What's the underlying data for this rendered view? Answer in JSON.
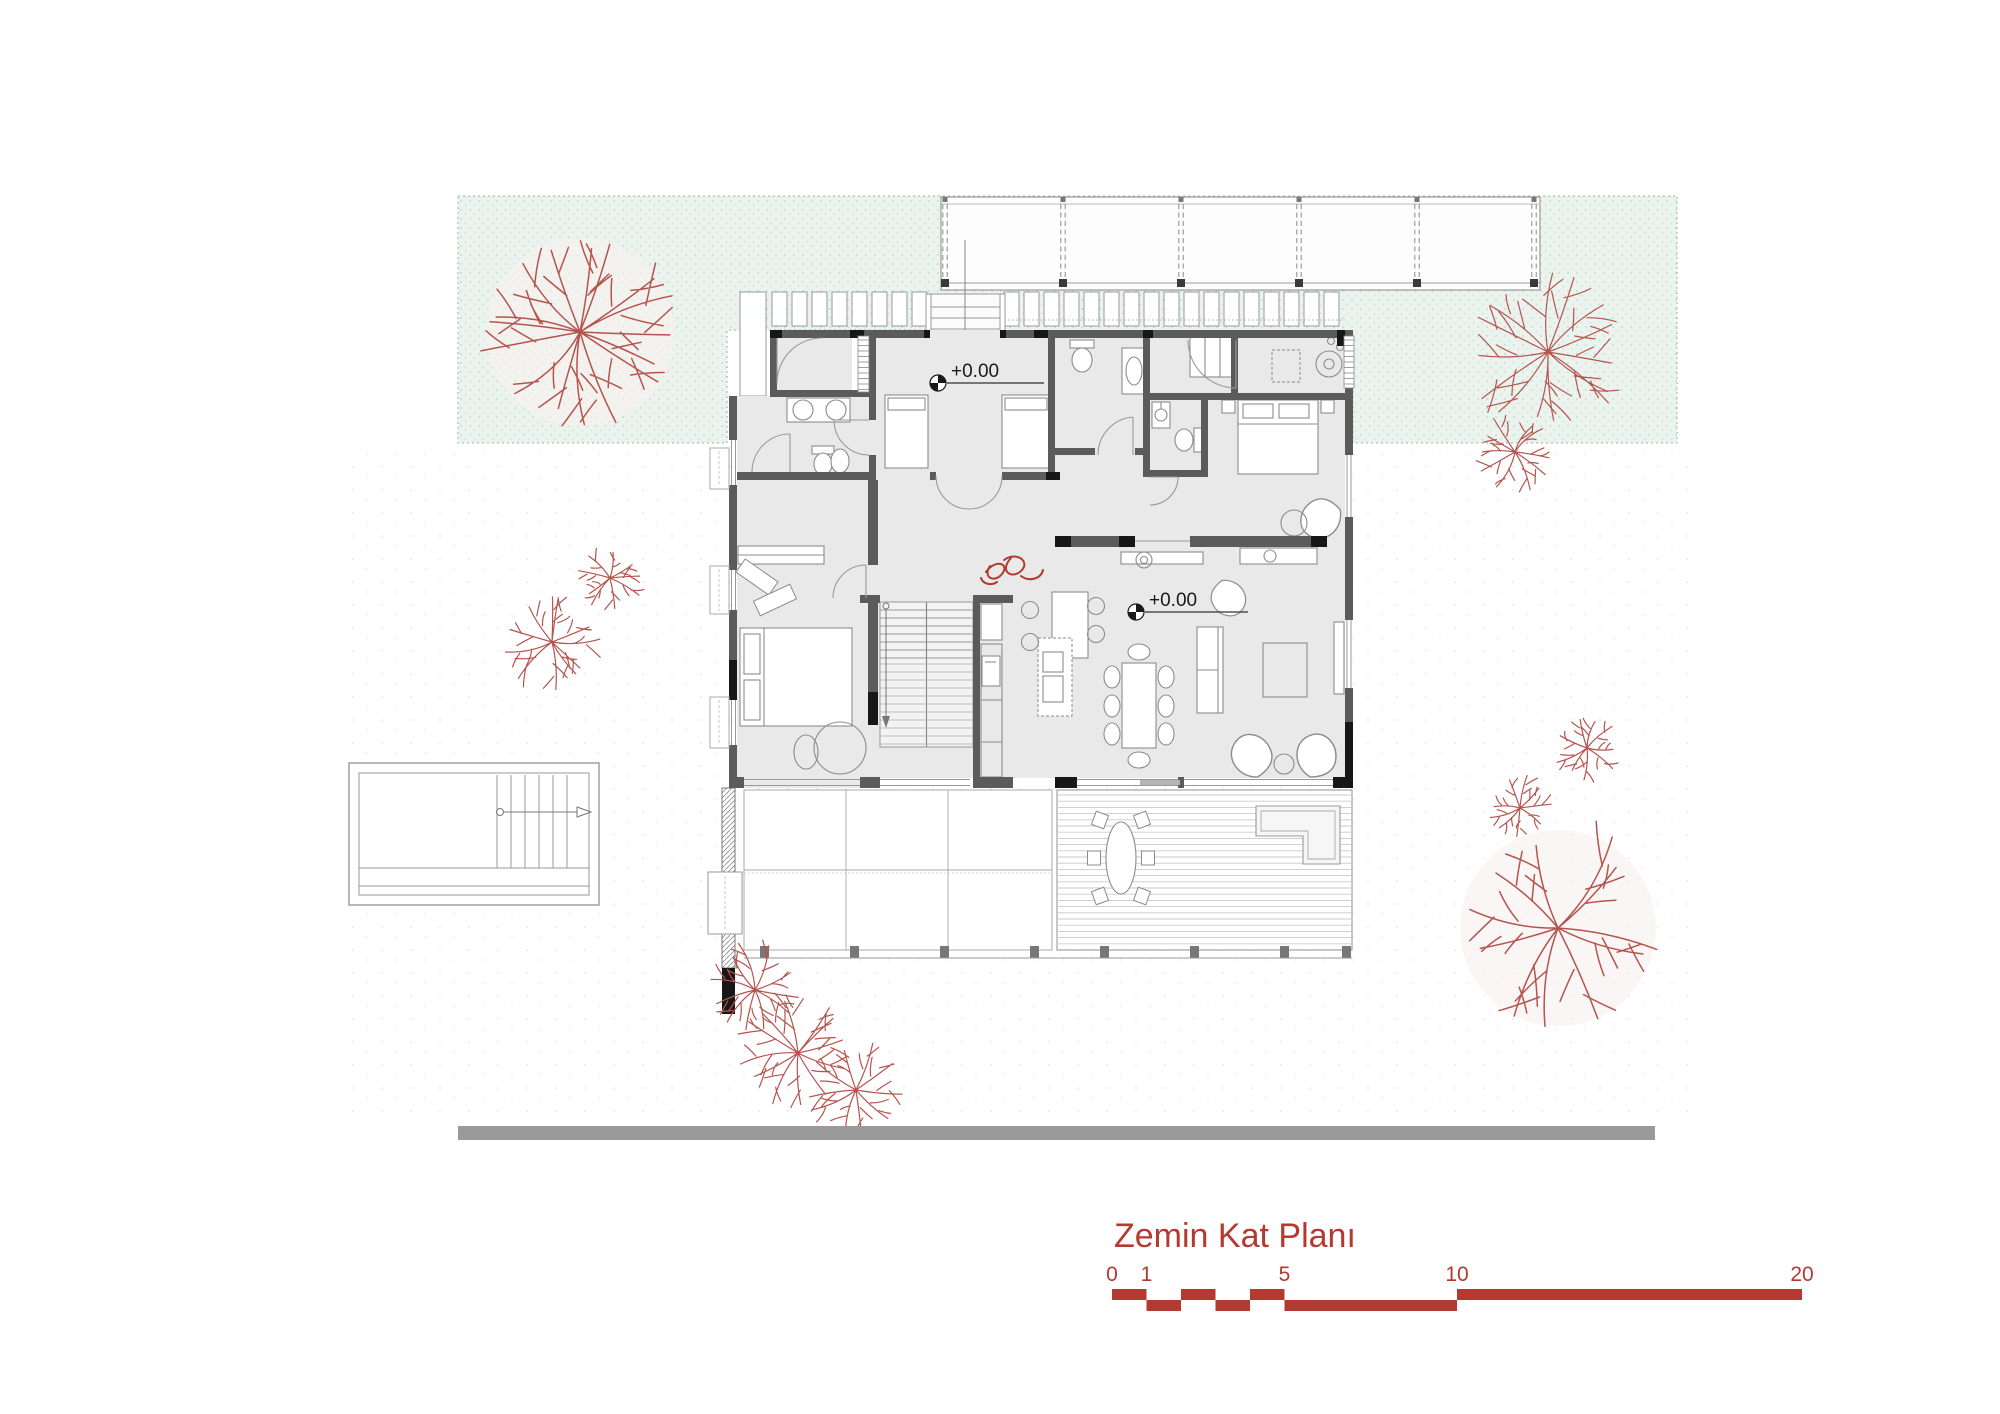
{
  "page": {
    "width": 2000,
    "height": 1414,
    "background": "#ffffff"
  },
  "title": {
    "text": "Zemin Kat Planı",
    "color": "#b23a31",
    "font_size": 34,
    "x": 1114,
    "y": 1247
  },
  "elevation_markers": [
    {
      "label": "+0.00",
      "cx": 938,
      "cy": 383,
      "text_x": 951,
      "text_y": 377,
      "underline_to": 1044
    },
    {
      "label": "+0.00",
      "cx": 1136,
      "cy": 612,
      "text_x": 1149,
      "text_y": 606,
      "underline_to": 1248
    }
  ],
  "scale_bar": {
    "x0": 1112,
    "y_top": 1289,
    "row_h": 11,
    "px_per_unit": 34.5,
    "color": "#b23a31",
    "label_baseline": 1281,
    "label_font_size": 21,
    "ticks": [
      {
        "label": "0",
        "value": 0
      },
      {
        "label": "1",
        "value": 1
      },
      {
        "label": "5",
        "value": 5
      },
      {
        "label": "10",
        "value": 10
      },
      {
        "label": "20",
        "value": 20
      }
    ],
    "segments": [
      {
        "from": 0,
        "to": 1,
        "row": "top"
      },
      {
        "from": 1,
        "to": 2,
        "row": "bottom"
      },
      {
        "from": 2,
        "to": 3,
        "row": "top"
      },
      {
        "from": 3,
        "to": 4,
        "row": "bottom"
      },
      {
        "from": 4,
        "to": 5,
        "row": "top"
      },
      {
        "from": 5,
        "to": 10,
        "row": "bottom"
      },
      {
        "from": 10,
        "to": 20,
        "row": "top"
      }
    ]
  },
  "road": {
    "x": 458,
    "y": 1126,
    "w": 1197,
    "h": 14,
    "color": "#9a9a9a"
  },
  "colors": {
    "lawn_fill": "#eaf3ee",
    "lawn_dots": "#c9ddd0",
    "lawn_border": "#9fb3a6",
    "wall": "#5b5b5b",
    "wall_accent": "#171717",
    "room_fill": "#e8e9e8",
    "furniture_stroke": "#8c8c8c",
    "thin_line": "#9a9a9a",
    "tree_stroke": "#b5544e",
    "tree_blush": "#f8f1f0",
    "accent_red": "#b23a31",
    "deck_slat": "#c9c9c9"
  },
  "plant_symbol": {
    "x": 986,
    "y": 560,
    "color": "#b23a31"
  },
  "trees": [
    {
      "cx": 580,
      "cy": 332,
      "r": 98,
      "branches": 16,
      "seed": 11
    },
    {
      "cx": 610,
      "cy": 578,
      "r": 33,
      "branches": 9,
      "seed": 21
    },
    {
      "cx": 552,
      "cy": 642,
      "r": 48,
      "branches": 11,
      "seed": 31
    },
    {
      "cx": 755,
      "cy": 990,
      "r": 48,
      "branches": 11,
      "seed": 41
    },
    {
      "cx": 798,
      "cy": 1053,
      "r": 58,
      "branches": 12,
      "seed": 51
    },
    {
      "cx": 856,
      "cy": 1090,
      "r": 48,
      "branches": 10,
      "seed": 61
    },
    {
      "cx": 1548,
      "cy": 352,
      "r": 78,
      "branches": 14,
      "seed": 71
    },
    {
      "cx": 1515,
      "cy": 452,
      "r": 40,
      "branches": 10,
      "seed": 81
    },
    {
      "cx": 1587,
      "cy": 748,
      "r": 33,
      "branches": 9,
      "seed": 91
    },
    {
      "cx": 1520,
      "cy": 808,
      "r": 32,
      "branches": 9,
      "seed": 101
    },
    {
      "cx": 1558,
      "cy": 928,
      "r": 102,
      "branches": 11,
      "seed": 111
    }
  ]
}
